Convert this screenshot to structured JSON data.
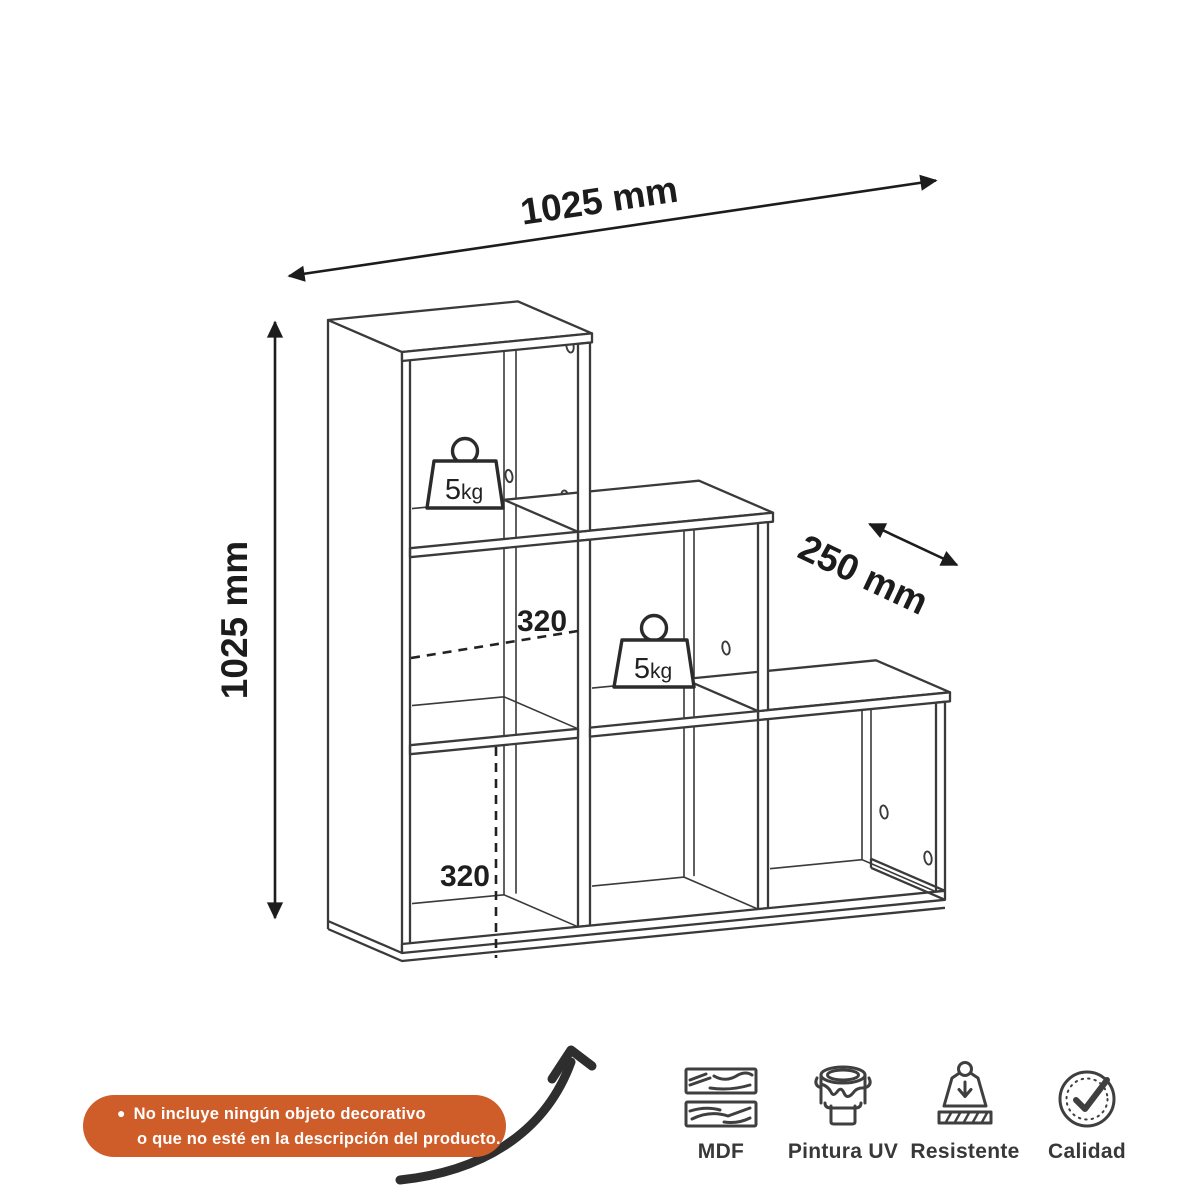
{
  "title": "step-shelf-technical-diagram",
  "dimensions": {
    "width_label": "1025 mm",
    "height_label": "1025 mm",
    "depth_label": "250 mm",
    "cell_width_label": "320",
    "cell_height_label": "320"
  },
  "weights": {
    "value": "5",
    "unit": "kg"
  },
  "note": {
    "bullet": "●",
    "line1": "No incluye ningún objeto decorativo",
    "line2": "o que no esté en la descripción del producto."
  },
  "features": [
    {
      "icon": "wood-planks-icon",
      "label": "MDF"
    },
    {
      "icon": "paint-bucket-icon",
      "label": "Pintura UV"
    },
    {
      "icon": "weight-icon",
      "label": "Resistente"
    },
    {
      "icon": "check-badge-icon",
      "label": "Calidad"
    }
  ],
  "colors": {
    "background": "#ffffff",
    "line": "#3a3a3a",
    "dimension_text": "#1c1c1c",
    "badge_background": "#CF5D2A",
    "badge_text": "#ffffff"
  }
}
